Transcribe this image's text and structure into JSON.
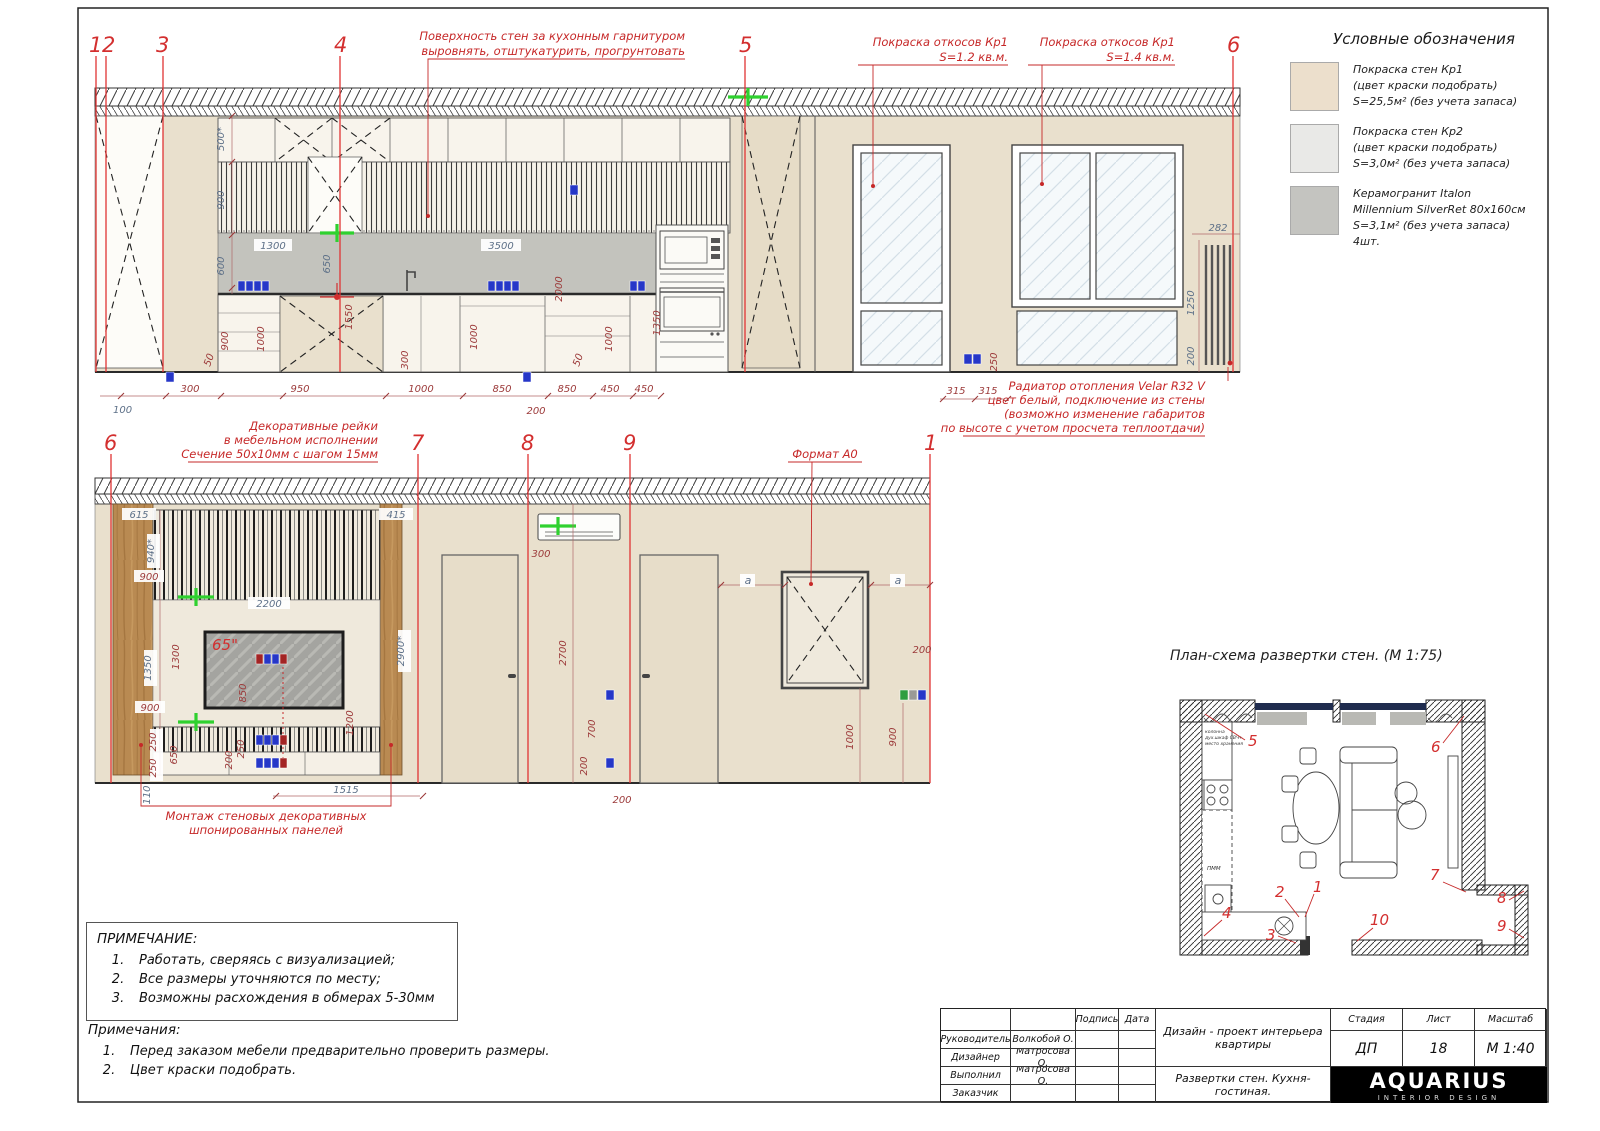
{
  "colors": {
    "beige": "#e9e0cd",
    "kp2": "#e9e9e7",
    "tile": "#c4c4c0",
    "backsplash": "#c3c3bd",
    "wood": "#b98a52",
    "red": "#d32f2f",
    "dim_red": "#9c3a3a",
    "dim_blue": "#5d7088",
    "green": "#2fd12f",
    "blue": "#2637c8"
  },
  "legend": {
    "title": "Условные обозначения",
    "items": [
      {
        "name": "paint-kp1",
        "lines": [
          "Покраска стен Кр1",
          "(цвет краски подобрать)",
          "S=25,5м² (без учета запаса)"
        ]
      },
      {
        "name": "paint-kp2",
        "lines": [
          "Покраска стен Кр2",
          "(цвет краски подобрать)",
          "S=3,0м² (без учета запаса)"
        ]
      },
      {
        "name": "ceramic",
        "lines": [
          "Керамогранит Italon",
          "Millennium SilverRet 80x160см",
          "S=3,1м² (без учета запаса)",
          "4шт."
        ]
      }
    ]
  },
  "elev_top": {
    "markers": [
      "1",
      "2",
      "3",
      "4",
      "5",
      "6"
    ],
    "ann_wall": [
      "Поверхность стен за кухонным гарнитуром",
      "выровнять, отштукатурить, прогрунтовать"
    ],
    "ann_slope_left": [
      "Покраска откосов Кр1",
      "S=1.2 кв.м."
    ],
    "ann_slope_right": [
      "Покраска откосов Кр1",
      "S=1.4 кв.м."
    ],
    "ann_radiator": [
      "Радиатор отопления Velar R32 V",
      "цвет белый, подключение из стены",
      "(возможно изменение габаритов",
      "по высоте с учетом просчета теплоотдачи)"
    ],
    "dims": [
      "500*",
      "900",
      "600",
      "1300",
      "650",
      "3500",
      "2000",
      "1350",
      "1550",
      "900",
      "1000",
      "1000",
      "1000",
      "50",
      "300",
      "50",
      "100",
      "300",
      "950",
      "1000",
      "850",
      "850",
      "450",
      "450",
      "200",
      "315",
      "315",
      "250",
      "282",
      "1250",
      "200"
    ]
  },
  "elev_bottom": {
    "markers": [
      "6",
      "7",
      "8",
      "9",
      "1"
    ],
    "ann_rails": [
      "Декоративные рейки",
      "в мебельном исполнении",
      "Сечение 50х10мм с шагом 15мм"
    ],
    "ann_panels": [
      "Монтаж стеновых декоративных",
      "шпонированных панелей"
    ],
    "ann_format": "Формат А0",
    "tv_size": "65\"",
    "dims": [
      "615",
      "415",
      "940*",
      "900",
      "2200",
      "1350",
      "1300",
      "900",
      "850",
      "250",
      "250",
      "650",
      "200",
      "250",
      "1200",
      "2900*",
      "110",
      "1515",
      "300",
      "2700",
      "700",
      "200",
      "200",
      "1000",
      "900",
      "200",
      "a",
      "a"
    ]
  },
  "plan": {
    "title": "План-схема развертки стен. (М 1:75)",
    "markers": [
      "1",
      "2",
      "3",
      "4",
      "5",
      "6",
      "7",
      "8",
      "9",
      "10"
    ],
    "kitchen_note": [
      "колонна",
      "дух.шкаф СВЧ+",
      "место хранения"
    ],
    "pmm": "ПММ"
  },
  "notes": {
    "box_title": "ПРИМЕЧАНИЕ:",
    "box_nums": [
      "1.",
      "2.",
      "3."
    ],
    "box_items": [
      "Работать, сверяясь с визуализацией;",
      "Все размеры уточняются по месту;",
      "Возможны расхождения в обмерах 5-30мм"
    ],
    "sub_title": "Примечания:",
    "sub_nums": [
      "1.",
      "2."
    ],
    "sub_items": [
      "Перед заказом мебели предварительно проверить размеры.",
      "Цвет краски подобрать."
    ]
  },
  "titleblock": {
    "rows": [
      {
        "label": "Руководитель",
        "name": "Волкобой О."
      },
      {
        "label": "Дизайнер",
        "name": "Матросова О."
      },
      {
        "label": "Выполнил",
        "name": "Матросова О."
      },
      {
        "label": "Заказчик",
        "name": ""
      }
    ],
    "sign": "Подпись",
    "date": "Дата",
    "project": [
      "Дизайн - проект интерьера",
      "квартиры"
    ],
    "doc_title": "Развертки стен. Кухня-гостиная.",
    "stage_h": "Стадия",
    "list_h": "Лист",
    "scale_h": "Масштаб",
    "stage": "ДП",
    "list": "18",
    "scale": "М 1:40",
    "logo": "AQUARIUS",
    "logo_sub": "INTERIOR DESIGN"
  }
}
